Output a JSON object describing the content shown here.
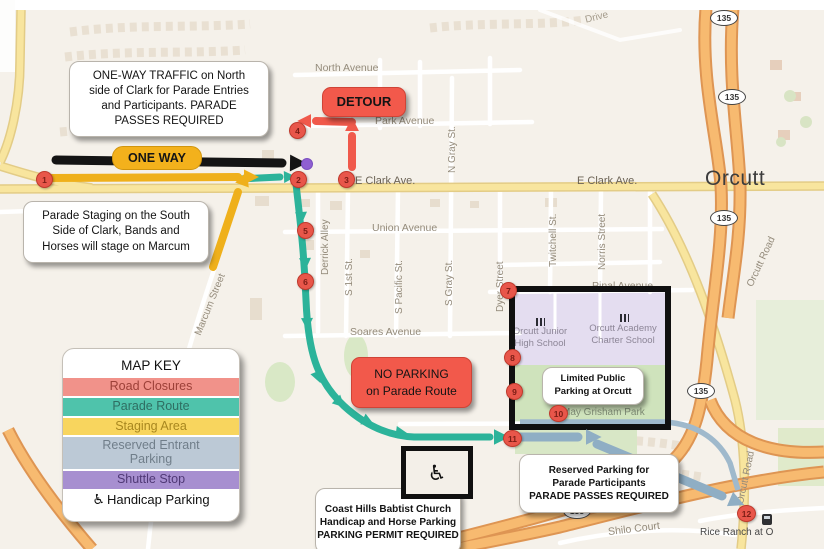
{
  "map": {
    "town": "Orcutt",
    "shield": "135",
    "transit_stop_label": "Rice Ranch at O",
    "park": "May Grisham Park",
    "schools": [
      {
        "name": "Orcutt Junior\nHigh School"
      },
      {
        "name": "Orcutt Academy\nCharter School"
      }
    ],
    "streets": [
      {
        "label": "North Avenue"
      },
      {
        "label": "Park Avenue"
      },
      {
        "label": "E Clark Ave."
      },
      {
        "label": "E Clark Ave."
      },
      {
        "label": "Union Avenue"
      },
      {
        "label": "Pinal Avenue"
      },
      {
        "label": "Soares Avenue"
      },
      {
        "label": "Shilo Court"
      },
      {
        "label": "Derrick Alley"
      },
      {
        "label": "S 1st St."
      },
      {
        "label": "S Pacific St."
      },
      {
        "label": "S Gray St."
      },
      {
        "label": "N Gray St."
      },
      {
        "label": "Dyer Street"
      },
      {
        "label": "Twitchell St."
      },
      {
        "label": "Norris Street"
      },
      {
        "label": "Marcum Street"
      },
      {
        "label": "Orcutt Road"
      },
      {
        "label": "Orcutt Road"
      },
      {
        "label": "Drive"
      }
    ]
  },
  "annotations": {
    "one_way_note": "ONE-WAY TRAFFIC on North\nside of Clark for Parade Entries\nand Participants. PARADE\nPASSES REQUIRED",
    "staging_note": "Parade Staging on the South\nSide of Clark, Bands and\nHorses will stage on Marcum",
    "detour": "DETOUR",
    "one_way": "ONE WAY",
    "no_parking": "NO PARKING\non Parade Route",
    "limited_parking": "Limited Public\nParking at Orcutt",
    "reserved_parking": "Reserved Parking for\nParade Participants\nPARADE PASSES REQUIRED",
    "church_parking": "Coast Hills Babtist Church\nHandicap and Horse Parking\nPARKING PERMIT REQUIRED"
  },
  "map_key": {
    "title": "MAP KEY",
    "items": [
      {
        "label": "Road Closures",
        "color": "#F1928A"
      },
      {
        "label": "Parade Route",
        "color": "#4FC3AB"
      },
      {
        "label": "Staging Area",
        "color": "#F8D55E"
      },
      {
        "label": "Reserved Entrant\nParking",
        "color": "#BCC9D6"
      },
      {
        "label": "Shuttle Stop",
        "color": "#A78FD0"
      }
    ],
    "handicap_label": "Handicap Parking"
  },
  "icons": {
    "handicap": "♿"
  },
  "markers": [
    "1",
    "2",
    "3",
    "4",
    "5",
    "6",
    "7",
    "8",
    "9",
    "10",
    "11",
    "12"
  ],
  "colors": {
    "route_teal": "#2CB39A",
    "staging_yellow": "#EFB01B",
    "closure_red": "#F0594B",
    "reserved_blue": "#8FAEC4",
    "one_way_black": "#141414",
    "shuttle_purple": "#8F5FD1",
    "marker_red": "#E8564A"
  }
}
